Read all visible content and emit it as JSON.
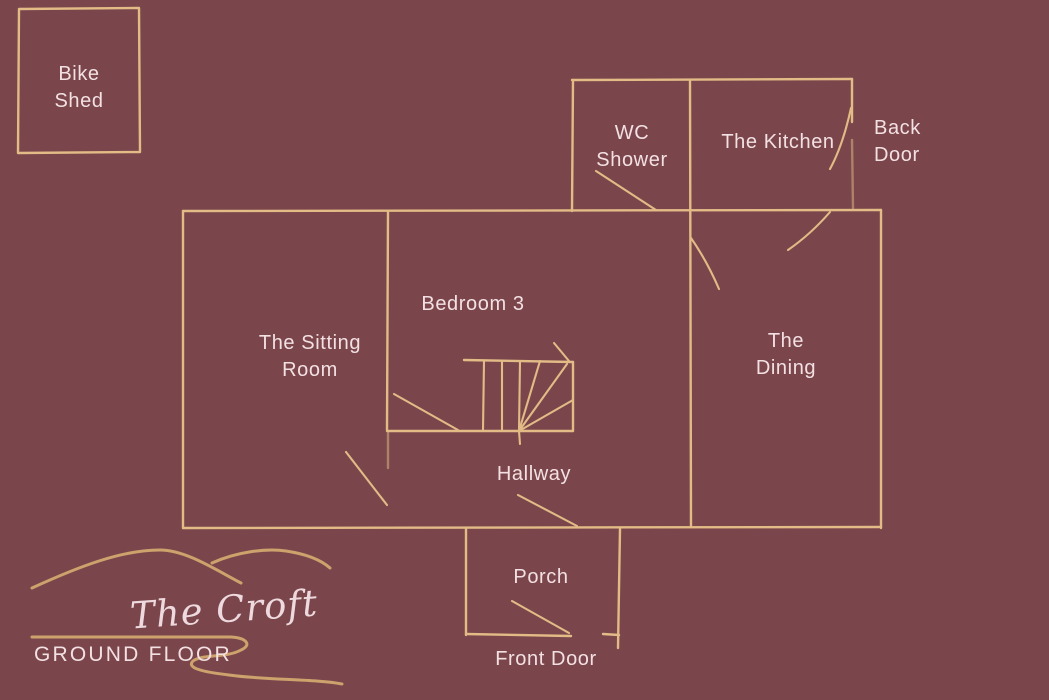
{
  "palette": {
    "background": "#7a464b",
    "wall_line": "#e2bb87",
    "decor_line": "#cda26c",
    "label_text": "#f3e0e3"
  },
  "plan": {
    "name": "The Croft",
    "floor": "GROUND FLOOR",
    "outbuilding": {
      "line1": "Bike",
      "line2": "Shed"
    },
    "rooms": {
      "wc_shower": {
        "line1": "WC",
        "line2": "Shower"
      },
      "kitchen": {
        "label": "The Kitchen"
      },
      "sitting_room": {
        "line1": "The Sitting",
        "line2": "Room"
      },
      "bedroom3": {
        "label": "Bedroom 3"
      },
      "dining": {
        "line1": "The",
        "line2": "Dining"
      },
      "hallway": {
        "label": "Hallway"
      },
      "porch": {
        "label": "Porch"
      }
    },
    "doors": {
      "back_door": {
        "line1": "Back",
        "line2": "Door"
      },
      "front_door": {
        "label": "Front Door"
      }
    }
  }
}
